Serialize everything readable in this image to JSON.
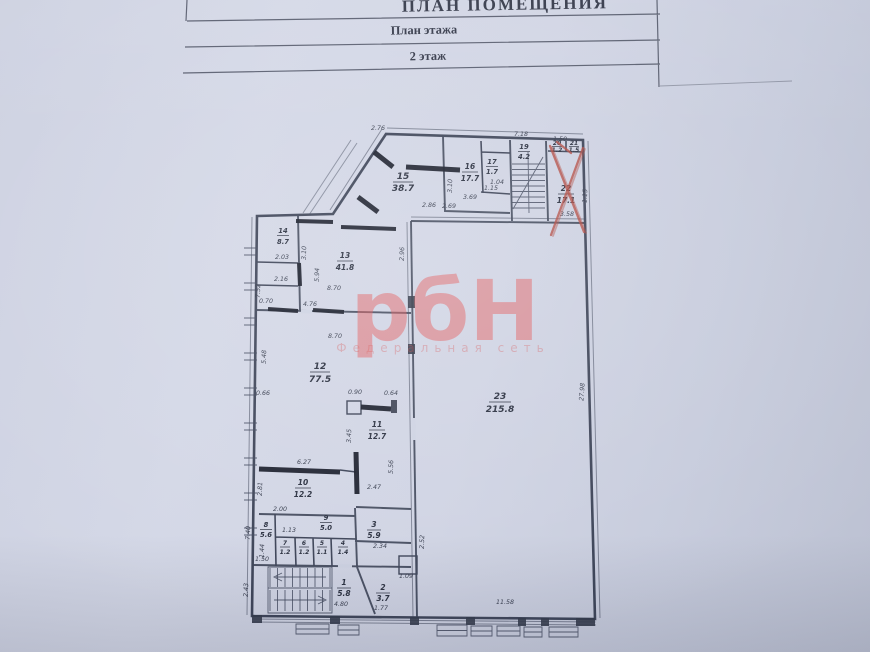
{
  "header": {
    "title": "ПЛАН ПОМЕЩЕНИЯ",
    "subtitle": "План этажа",
    "floor": "2 этаж"
  },
  "watermark": {
    "logo": "рбН",
    "tagline": "Федеральная сеть"
  },
  "colors": {
    "paper": "#cdd2e2",
    "ink": "#3a4155",
    "hatch_wall": "#141826",
    "red_pencil": "#b0473e",
    "watermark_red": "#e25353"
  },
  "plan": {
    "rooms": {
      "r1": {
        "num": "1",
        "area": "5.8"
      },
      "r2": {
        "num": "2",
        "area": "3.7"
      },
      "r3": {
        "num": "3",
        "area": "5.9"
      },
      "r4": {
        "num": "4",
        "area": "1.4"
      },
      "r5": {
        "num": "5",
        "area": "1.1"
      },
      "r6": {
        "num": "6",
        "area": "1.2"
      },
      "r7": {
        "num": "7",
        "area": "1.2"
      },
      "r8": {
        "num": "8",
        "area": "5.6"
      },
      "r9": {
        "num": "9",
        "area": "5.0"
      },
      "r10": {
        "num": "10",
        "area": "12.2"
      },
      "r11": {
        "num": "11",
        "area": "12.7"
      },
      "r12": {
        "num": "12",
        "area": "77.5"
      },
      "r13": {
        "num": "13",
        "area": "41.8"
      },
      "r14": {
        "num": "14",
        "area": "8.7"
      },
      "r15": {
        "num": "15",
        "area": "38.7"
      },
      "r16": {
        "num": "16",
        "area": "17.7"
      },
      "r17": {
        "num": "17",
        "area": "1.7"
      },
      "r19": {
        "num": "19",
        "area": "4.2"
      },
      "r20": {
        "num": "20",
        "area": "1.2"
      },
      "r21": {
        "num": "21",
        "area": "1.5"
      },
      "r22": {
        "num": "22",
        "area": "17.1"
      },
      "r23": {
        "num": "23",
        "area": "215.8"
      }
    },
    "dims": {
      "d01": "2.76",
      "d02": "7.18",
      "d03": "1.50",
      "d04": "3.69",
      "d05": "2.69",
      "d06": "2.86",
      "d07": "3.10",
      "d08": "2.96",
      "d09": "2.03",
      "d10": "2.16",
      "d11": "5.94",
      "d12": "8.70",
      "d13": "7.52",
      "d14": "0.70",
      "d15": "4.76",
      "d16": "8.70",
      "d17": "5.48",
      "d18": "0.90",
      "d19": "0.64",
      "d20": "3.45",
      "d21": "6.27",
      "d22": "5.56",
      "d23": "2.47",
      "d24": "2.81",
      "d25": "2.00",
      "d26": "1.13",
      "d27": "1.44",
      "d28": "1.50",
      "d29": "7.40",
      "d30": "2.43",
      "d31": "2.34",
      "d32": "4.80",
      "d33": "1.77",
      "d34": "1.09",
      "d35": "11.58",
      "d36": "27.98",
      "d37": "3.58",
      "d38": "1.15",
      "d39": "1.04",
      "d40": "1.15",
      "d41": "2.52",
      "d42": "0.66",
      "d43": "3.10"
    }
  }
}
